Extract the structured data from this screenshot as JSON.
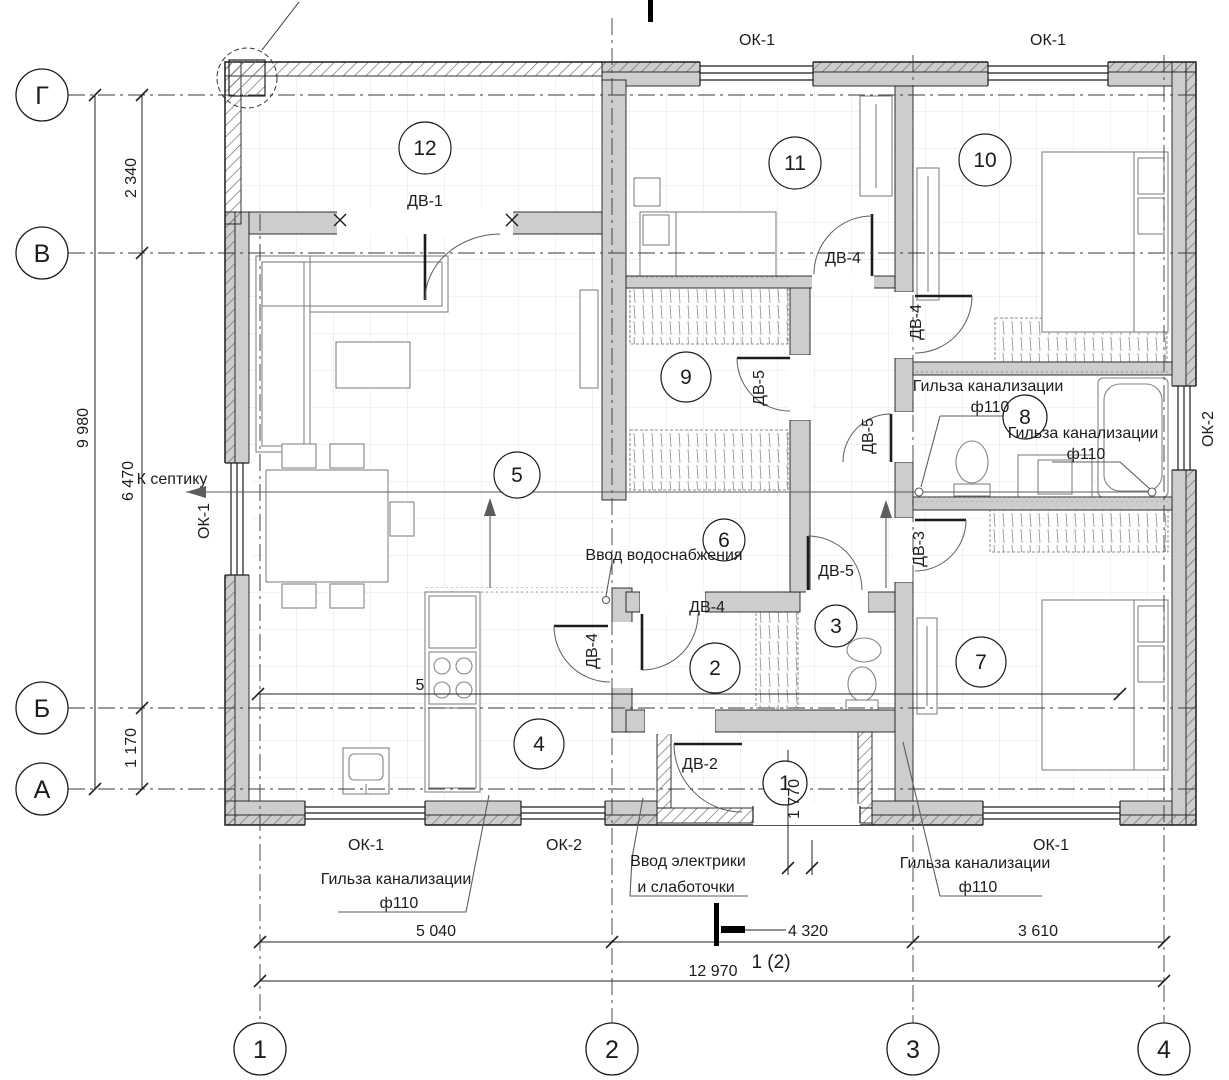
{
  "drawing": {
    "axes": {
      "h": [
        "Г",
        "В",
        "Б",
        "А"
      ],
      "v": [
        "1",
        "2",
        "3",
        "4"
      ]
    },
    "rooms": [
      "1",
      "2",
      "3",
      "4",
      "5",
      "6",
      "7",
      "8",
      "9",
      "10",
      "11",
      "12"
    ],
    "windows": {
      "ok1": "ОК-1",
      "ok2": "ОК-2"
    },
    "doors": {
      "dv1": "ДВ-1",
      "dv2": "ДВ-2",
      "dv3": "ДВ-3",
      "dv4": "ДВ-4",
      "dv5": "ДВ-5"
    },
    "dims": {
      "total_v": "9 980",
      "seg_v": [
        "2 340",
        "6 470",
        "1 170"
      ],
      "bottom": [
        "5 040",
        "4 320",
        "3 610"
      ],
      "total_h": "12 970",
      "entry": "1 770",
      "internal": "5"
    },
    "section": {
      "label": "1 (2)"
    },
    "annotations": {
      "septic": "К септику",
      "water": "Ввод водоснабжения",
      "sleeve": "Гильза канализации",
      "f110": "ф110",
      "elec1": "Ввод электрики",
      "elec2": "и слаботочки"
    },
    "colors": {
      "wall": "#cdcdcd",
      "line": "#1c1c1c",
      "tile": "#e6e6e6"
    }
  }
}
